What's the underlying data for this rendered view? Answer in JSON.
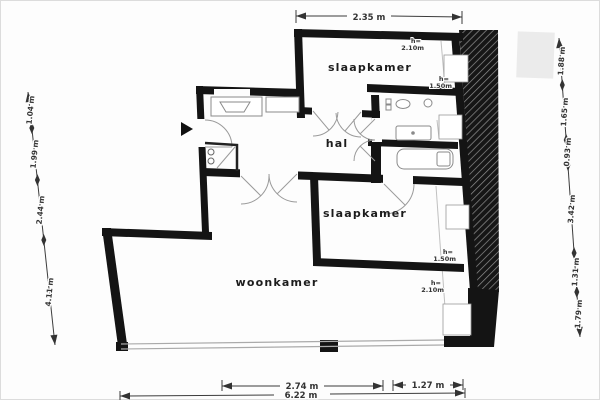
{
  "rooms": {
    "top_bedroom": "slaapkamer",
    "hall": "hal",
    "right_bedroom": "slaapkamer",
    "living_room": "woonkamer"
  },
  "height_labels": {
    "top_210": {
      "k": "h=",
      "v": "2.10m"
    },
    "top_150": {
      "k": "h=",
      "v": "1.50m"
    },
    "mid_150": {
      "k": "h=",
      "v": "1.50m"
    },
    "mid_210": {
      "k": "h=",
      "v": "2.10m"
    }
  },
  "dimensions": {
    "top": "2.35 m",
    "bottom_segments": [
      "2.74 m",
      "1.27 m"
    ],
    "bottom_total": "6.22 m",
    "left": [
      "1.04 m",
      "1.99 m",
      "2.44 m",
      "4.11 m"
    ],
    "right": [
      "1.88 m",
      "1.65 m",
      "0.93 m",
      "3.42 m",
      "1.31 m",
      "1.79 m"
    ]
  },
  "colors": {
    "wall": "#141414",
    "dimension_text": "#333333",
    "fixture_line": "#8a8a8a",
    "hatch_dark": "#161616",
    "watermark": "#ebebeb"
  }
}
